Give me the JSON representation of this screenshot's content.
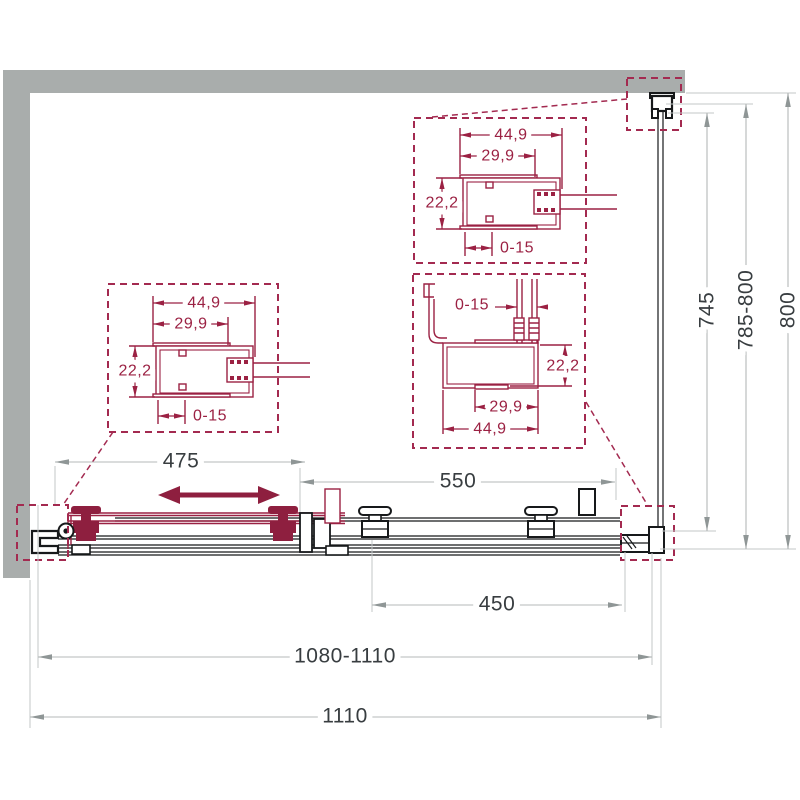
{
  "drawing_type": "shower-sliding-door-technical-drawing",
  "colors": {
    "accent_maroon": "#9b2143",
    "wall_gray": "#a9adac",
    "dim_line_gray": "#b5b9b9",
    "text_dark": "#383d40",
    "line_black": "#17191b"
  },
  "plan": {
    "dim_opening": "475",
    "dim_fixed_panel": "550",
    "dim_door": "450",
    "dim_width_range": "1080-1110",
    "dim_total_width": "1110"
  },
  "heights": {
    "dim_glass": "745",
    "dim_height_range": "785-800",
    "dim_total_height": "800"
  },
  "corner_profile": {
    "outer_width": "44,9",
    "inner_width": "29,9",
    "depth": "22,2",
    "adjustment": "0-15"
  },
  "wall_profile_detail": {
    "adjustment": "0-15",
    "depth": "22,2",
    "inner_width": "29,9",
    "outer_width": "44,9"
  },
  "icons": {
    "slide_direction": "double-headed-arrow"
  }
}
